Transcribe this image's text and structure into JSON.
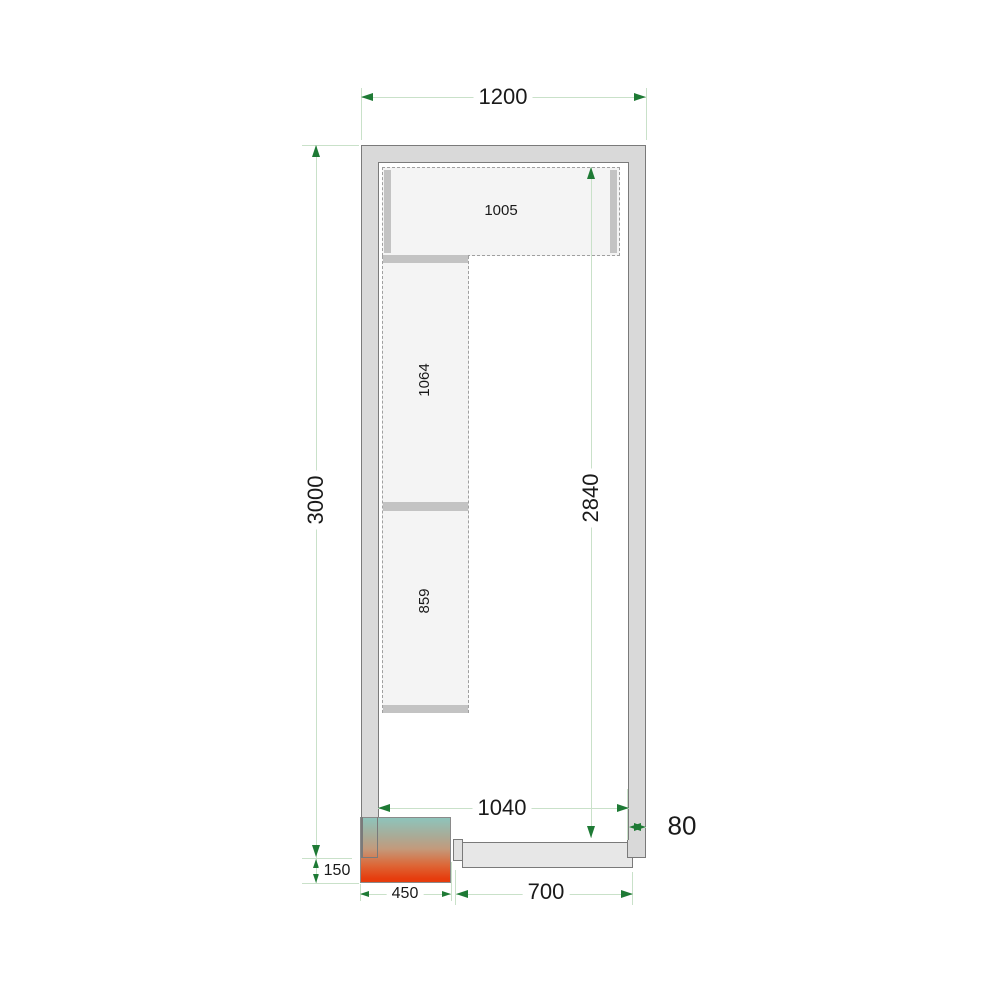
{
  "dimensions": {
    "outer_width": "1200",
    "outer_height": "3000",
    "inner_height": "2840",
    "inner_width": "1040",
    "wall_thickness": "80",
    "unit_protrusion": "150",
    "unit_width": "450",
    "door_width": "700"
  },
  "shelves": {
    "top_shelf": "1005",
    "left_upper_shelf": "1064",
    "left_lower_shelf": "859"
  },
  "colors": {
    "wall_fill": "#d9d9d9",
    "wall_stroke": "#7a7a7a",
    "shelf_fill": "#f4f4f4",
    "shelf_support": "#c3c3c3",
    "door_fill": "#e7e7e7",
    "dimension_line": "#c9e1c9",
    "dimension_arrow": "#1e7a35",
    "unit_gradient_top": "#8ec4bb",
    "unit_gradient_bottom": "#e63c0d"
  }
}
